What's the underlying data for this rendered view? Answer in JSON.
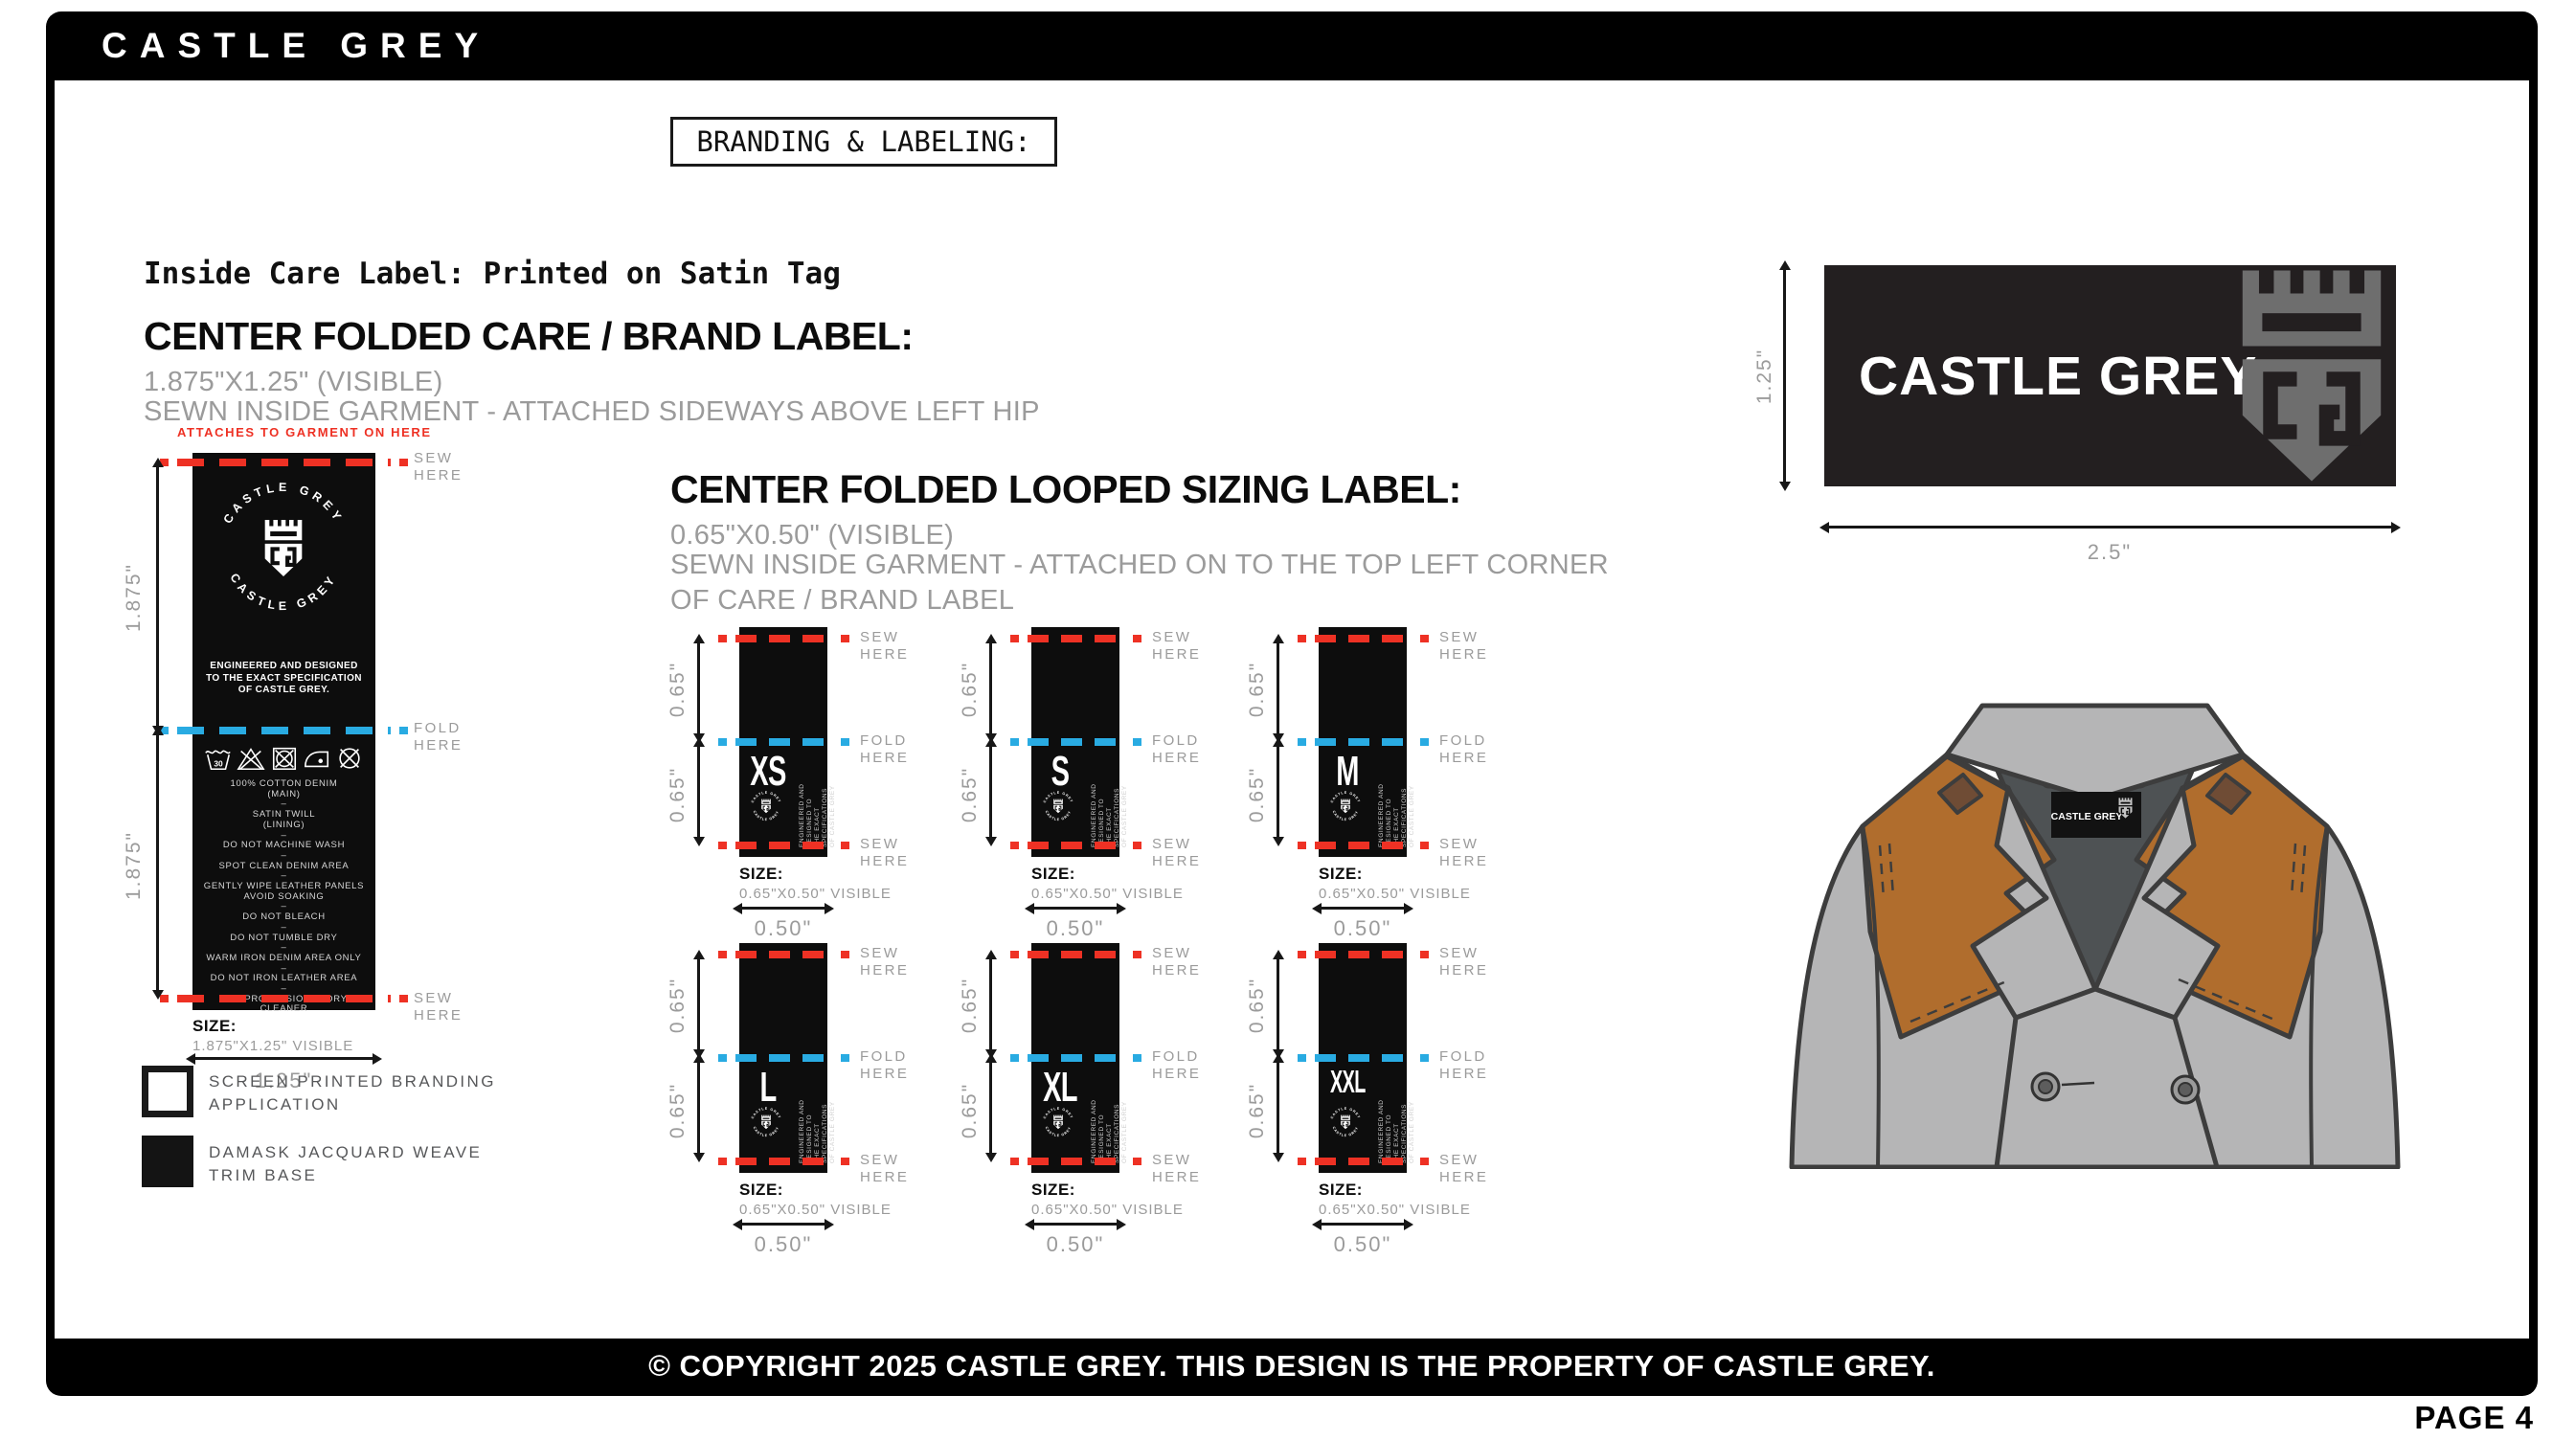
{
  "header": {
    "brand": "CASTLE GREY",
    "section_tag": "BRANDING & LABELING:"
  },
  "care_section": {
    "intro": "Inside Care Label: Printed on Satin Tag",
    "title": "CENTER FOLDED CARE / BRAND LABEL:",
    "dimensions": "1.875\"X1.25\" (VISIBLE)",
    "placement": "SEWN INSIDE GARMENT - ATTACHED SIDEWAYS ABOVE LEFT HIP",
    "attach_note": "ATTACHES TO GARMENT ON HERE",
    "label": {
      "arc_top": "CASTLE GREY",
      "arc_bottom": "CASTLE GREY",
      "tagline": "ENGINEERED AND DESIGNED\nTO THE EXACT SPECIFICATION\nOF CASTLE GREY.",
      "handwash_temp": "30",
      "care_icon_names": [
        "handwash-30-icon",
        "do-not-bleach-icon",
        "do-not-tumble-dry-icon",
        "iron-icon",
        "do-not-dry-clean-icon"
      ],
      "care_lines": "100% COTTON DENIM\n(MAIN)\n–\nSATIN TWILL\n(LINING)\n–\nDO NOT MACHINE WASH\n–\nSPOT CLEAN DENIM AREA\n–\nGENTLY WIPE LEATHER PANELS\nAVOID SOAKING\n–\nDO NOT BLEACH\n–\nDO NOT TUMBLE DRY\n–\nWARM IRON DENIM AREA ONLY\n–\nDO NOT IRON LEATHER AREA\n–\nUSE PROFESSIONAL DRY CLEANER",
      "half_height": "1.875\"",
      "size_caption": "SIZE:",
      "size_value": "1.875\"X1.25\" VISIBLE",
      "visible_width": "1.25\""
    }
  },
  "legend": {
    "items": [
      {
        "swatch": "white",
        "label": "SCREEN PRINTED BRANDING\nAPPLICATION"
      },
      {
        "swatch": "black",
        "label": "DAMASK JACQUARD WEAVE\nTRIM BASE"
      }
    ]
  },
  "sizing_section": {
    "title": "CENTER FOLDED LOOPED SIZING LABEL:",
    "dimensions": "0.65\"X0.50\" (VISIBLE)",
    "placement": "SEWN INSIDE GARMENT - ATTACHED ON TO THE TOP LEFT CORNER\nOF CARE / BRAND LABEL",
    "sizes": [
      "XS",
      "S",
      "M",
      "L",
      "XL",
      "XXL"
    ],
    "half_height": "0.65\"",
    "size_caption": "SIZE:",
    "size_value": "0.65\"X0.50\" VISIBLE",
    "visible_width": "0.50\"",
    "micro_text": "ENGINEERED AND DESIGNED TO\nTHE EXACT SPECIFICATIONS\nOF CASTLE GREY",
    "stamp_arc_top": "CASTLE GREY",
    "stamp_arc_bottom": "CASTLE GREY"
  },
  "annotations": {
    "sew": "SEW\nHERE",
    "fold": "FOLD\nHERE"
  },
  "brand_label": {
    "name": "CASTLE GREY",
    "height": "1.25\"",
    "width": "2.5\""
  },
  "jacket": {
    "neck_label": "CASTLE GREY"
  },
  "footer": {
    "copyright": "© COPYRIGHT 2025 CASTLE GREY. THIS DESIGN IS THE PROPERTY OF CASTLE GREY.",
    "page": "PAGE 4"
  },
  "colors": {
    "red": "#ee3124",
    "blue": "#29abe2",
    "label_black": "#0d0d0d",
    "brand_label_bg": "#231f20",
    "gray_text": "#9b9b9b",
    "legend_text": "#57585a",
    "logo_grey": "#6e6e6e",
    "jacket_grey": "#b5b5b6",
    "jacket_outline": "#3d3d3d",
    "jacket_lining": "#4e5254",
    "leather_brown": "#b06d2d",
    "ink": "#111111"
  }
}
